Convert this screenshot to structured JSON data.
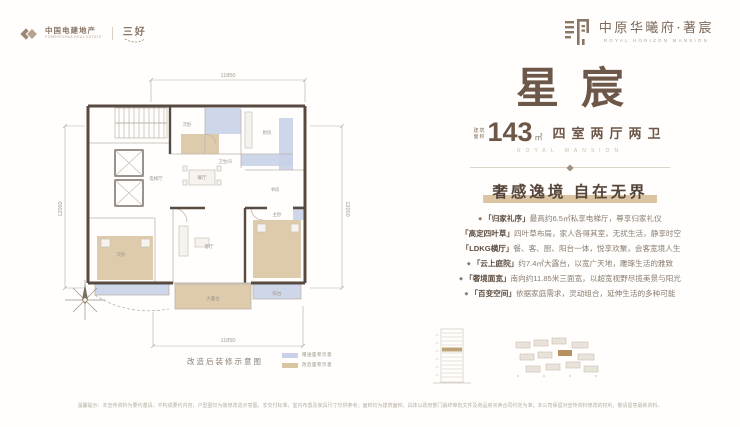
{
  "header": {
    "brand_left": {
      "name": "中国电建地产",
      "name_en": "POWERCHINA REAL ESTATE",
      "sub_brand": "三好"
    },
    "brand_right": {
      "name": "中原华曦府·著宸",
      "name_en": "ROYAL HORIZON MANSION"
    }
  },
  "floorplan": {
    "dimensions": {
      "top": "11850",
      "bottom": "11850",
      "left": "12050",
      "right": "12050"
    },
    "rooms": {
      "hall": "电梯厅",
      "bedroom_a": "次卧",
      "kitchen": "厨房",
      "bath": "卫生间",
      "dining": "餐厅",
      "study": "书房",
      "living": "客厅",
      "bedroom_b": "次卧",
      "master": "主卧",
      "terrace": "大露台",
      "balcony": "阳台"
    },
    "caption": "改造后装修示意图",
    "legend": [
      {
        "color": "#c9d1e8",
        "label": "赠送面积示意"
      },
      {
        "color": "#d9c5a2",
        "label": "改造面积示意"
      }
    ]
  },
  "panel": {
    "title": "星宸",
    "area_label_line1": "建筑",
    "area_label_line2": "面积",
    "area_value": "143",
    "area_unit": "㎡",
    "spec": "四室两厅两卫",
    "subtitle_en": "ROYAL MANSION",
    "tagline": "奢感逸境 自在无界",
    "bullets": [
      {
        "mark": "◆",
        "head": "「归家礼序」",
        "text": "最高约6.5㎡私享电梯厅，尊享归家礼仪"
      },
      {
        "mark": "",
        "head": "「高定四叶草」",
        "text": "四叶草布局，家人各得其室，无扰生活，静享时空"
      },
      {
        "mark": "",
        "head": "「LDKG横厅」",
        "text": "餐、客、厨、阳台一体，悦享欢聚，会客宽境人生"
      },
      {
        "mark": "◆",
        "head": "「云上庭院」",
        "text": "约7.4㎡大露台，以宽广天地，雕琢生活的雅致"
      },
      {
        "mark": "◆",
        "head": "「奢境面宽」",
        "text": "南向约11.85米三面宽，以超宽视野尽揽美景与阳光"
      },
      {
        "mark": "◆",
        "head": "「百变空间」",
        "text": "依据家庭需求，灵动组合，延伸生活的多种可能"
      }
    ]
  },
  "disclaimer": "温馨提示：本宣传资料为要约邀请，不构成要约内容；户型图仅为装修改造示意图，非交付标准，室内布置及家具尺寸仅供参考；面积均为建筑面积，具体以政府部门最终审批文件及商品房买卖合同约定为准；本公司保留对宣传资料修改的权利，敬请留意最新资料。"
}
